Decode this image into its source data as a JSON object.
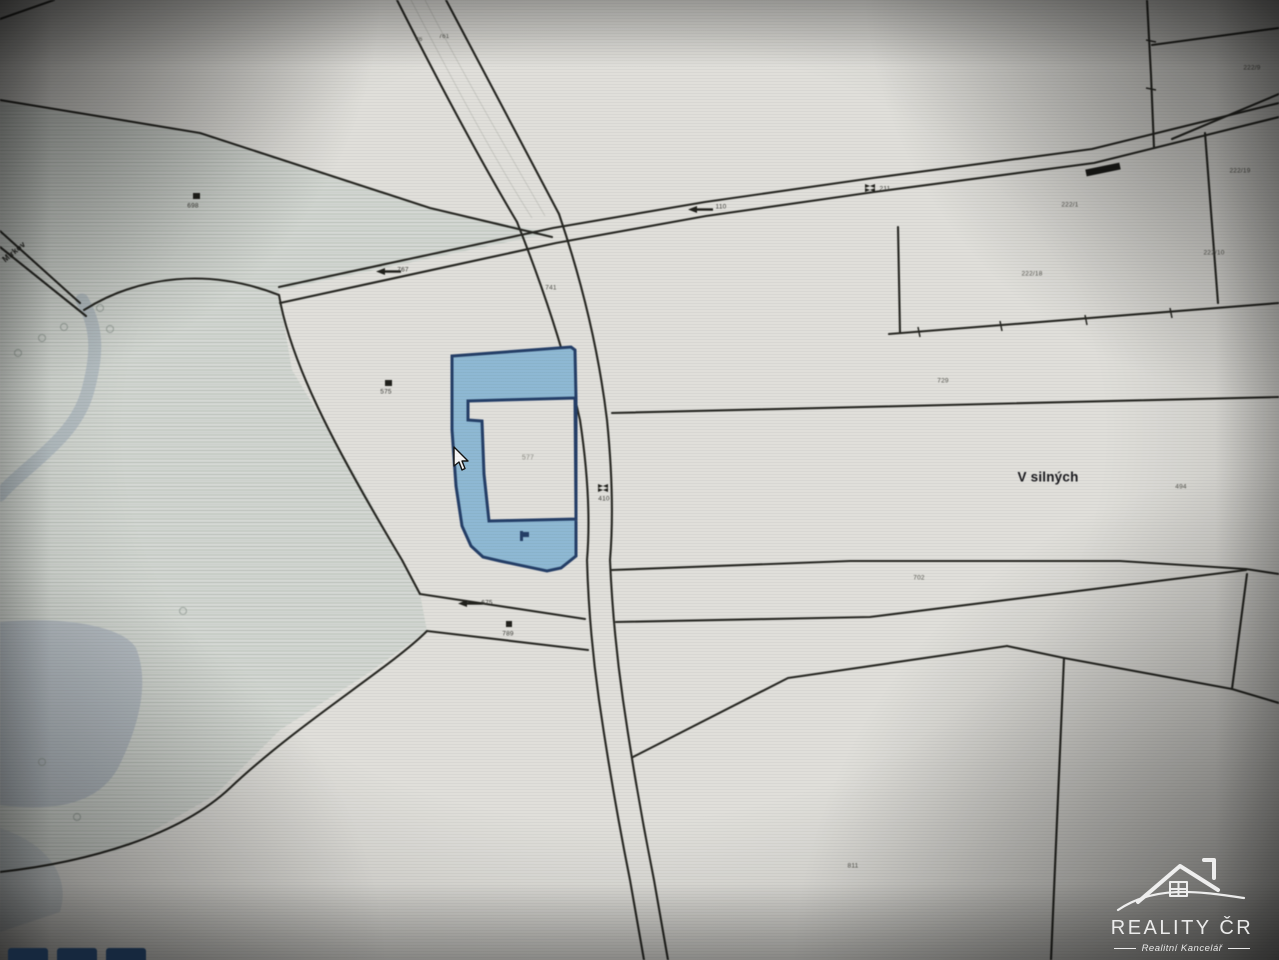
{
  "watermark": {
    "title": "REALITY ČR",
    "subtitle": "Realitní Kancelář"
  },
  "cursor": {
    "x": 452,
    "y": 446
  },
  "map": {
    "place_label": "V silných",
    "colors": {
      "paper": "#e9e8e3",
      "line": "#24241f",
      "highlight_fill": "#8fc0de",
      "highlight_border": "#1f3d6d",
      "water": "#b7c1c9",
      "hatch_tint": "#dde1dc"
    },
    "labels": [
      {
        "name": "place-name-label",
        "text": "V silných",
        "x": 1048,
        "y": 477,
        "size": 13.5,
        "color": "#15151a",
        "weight": 600
      },
      {
        "name": "parcel-number-label",
        "text": "577",
        "x": 528,
        "y": 458,
        "size": 7,
        "color": "#8e8e86"
      },
      {
        "name": "parcel-number-label",
        "text": "575",
        "x": 386,
        "y": 392,
        "size": 6.5,
        "color": "#3a3a35"
      },
      {
        "name": "parcel-number-label",
        "text": "698",
        "x": 193,
        "y": 206,
        "size": 6.5,
        "color": "#3a3a35"
      },
      {
        "name": "parcel-number-label",
        "text": "789",
        "x": 508,
        "y": 634,
        "size": 6.5,
        "color": "#3a3a35"
      },
      {
        "name": "road-number-label",
        "text": "410",
        "x": 604,
        "y": 499,
        "size": 6.5,
        "color": "#3a3a35"
      },
      {
        "name": "road-number-label",
        "text": "211",
        "x": 885,
        "y": 189,
        "size": 6.5,
        "color": "#3a3a35"
      },
      {
        "name": "road-number-label",
        "text": "110",
        "x": 721,
        "y": 207,
        "size": 6.5,
        "color": "#3a3a35"
      },
      {
        "name": "road-number-label",
        "text": "767",
        "x": 403,
        "y": 270,
        "size": 6.5,
        "color": "#3a3a35"
      },
      {
        "name": "road-number-label",
        "text": "675",
        "x": 487,
        "y": 603,
        "size": 6.5,
        "color": "#3a3a35"
      },
      {
        "name": "parcel-number-label",
        "text": "741",
        "x": 551,
        "y": 288,
        "size": 6.5,
        "color": "#55554e"
      },
      {
        "name": "parcel-number-label",
        "text": "729",
        "x": 943,
        "y": 381,
        "size": 6.5,
        "color": "#55554e"
      },
      {
        "name": "parcel-number-label",
        "text": "702",
        "x": 919,
        "y": 578,
        "size": 6.5,
        "color": "#55554e"
      },
      {
        "name": "parcel-number-label",
        "text": "494",
        "x": 1181,
        "y": 487,
        "size": 6.5,
        "color": "#55554e"
      },
      {
        "name": "parcel-number-label",
        "text": "222/18",
        "x": 1032,
        "y": 274,
        "size": 6.5,
        "color": "#55554e"
      },
      {
        "name": "parcel-number-label",
        "text": "222/1",
        "x": 1070,
        "y": 205,
        "size": 6.5,
        "color": "#55554e"
      },
      {
        "name": "parcel-number-label",
        "text": "222/19",
        "x": 1240,
        "y": 171,
        "size": 6.5,
        "color": "#55554e"
      },
      {
        "name": "parcel-number-label",
        "text": "222/9",
        "x": 1252,
        "y": 68,
        "size": 6.5,
        "color": "#55554e"
      },
      {
        "name": "parcel-number-label",
        "text": "222/10",
        "x": 1214,
        "y": 253,
        "size": 6.5,
        "color": "#55554e"
      },
      {
        "name": "parcel-number-label",
        "text": "811",
        "x": 853,
        "y": 866,
        "size": 6.5,
        "color": "#55554e"
      },
      {
        "name": "road-number-label",
        "text": "36",
        "x": 419,
        "y": 40,
        "size": 6,
        "color": "#55554e"
      },
      {
        "name": "road-number-label",
        "text": "761",
        "x": 444,
        "y": 37,
        "size": 6,
        "color": "#55554e"
      },
      {
        "name": "street-name-label",
        "text": "Mírkov",
        "x": 14,
        "y": 252,
        "size": 8,
        "color": "#20201c",
        "weight": 700,
        "rotate": -40
      }
    ]
  }
}
